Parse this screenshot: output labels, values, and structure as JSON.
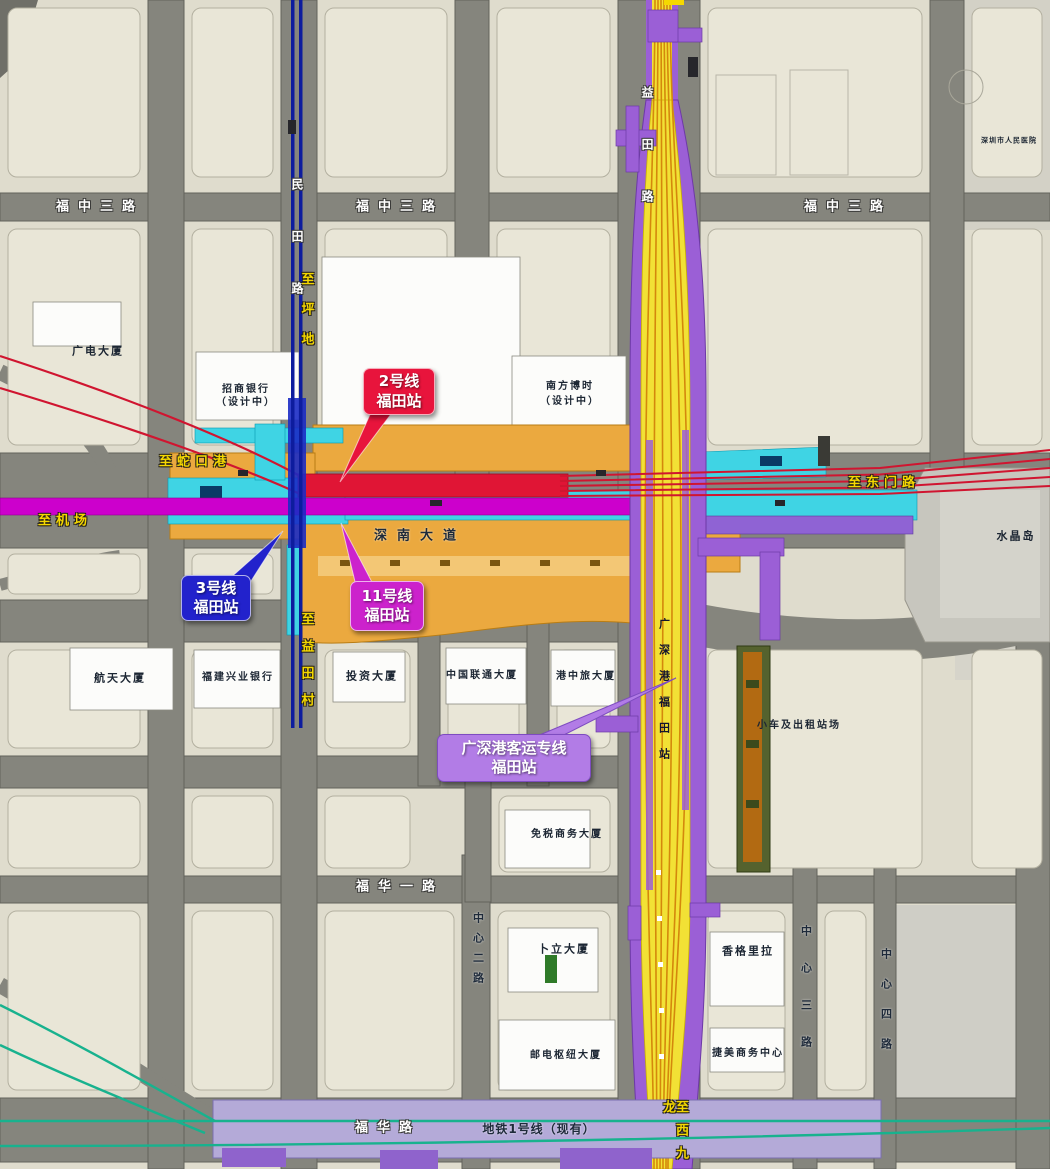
{
  "map_title": "福田站综合交通枢纽平面示意",
  "colors": {
    "line2_red": "#e8143c",
    "line3_blue": "#2222cc",
    "line11_magenta": "#cc22cc",
    "hsr_callout_purple": "#b27ce6",
    "hsr_corridor_yellow": "#f2e135",
    "corridor_flank_purple": "#9b5fd6",
    "metro1_existing_band": "#b4aad8",
    "line3_station_cyan": "#3fd4e4",
    "station_complex_orange": "#eba93f",
    "direction_label_yellow": "#f5d800",
    "teal_line_green": "#18b28e",
    "road_grey": "#85857d",
    "block_beige": "#e9e6d7"
  },
  "callouts": [
    {
      "id": "line2",
      "lines": [
        "2号线",
        "福田站"
      ],
      "color": "#e8143c"
    },
    {
      "id": "line3",
      "lines": [
        "3号线",
        "福田站"
      ],
      "color": "#2222cc"
    },
    {
      "id": "line11",
      "lines": [
        "11号线",
        "福田站"
      ],
      "color": "#cc22cc"
    },
    {
      "id": "grs",
      "lines": [
        "广深港客运专线",
        "福田站"
      ],
      "color": "#b27ce6"
    }
  ],
  "labels": [
    {
      "text": "福中三路",
      "type": "road",
      "x": 100,
      "y": 207,
      "ls": 9,
      "name": "road-label-fuzhong3-west"
    },
    {
      "text": "福中三路",
      "type": "road",
      "x": 400,
      "y": 207,
      "ls": 9,
      "name": "road-label-fuzhong3-mid"
    },
    {
      "text": "福中三路",
      "type": "road",
      "x": 848,
      "y": 207,
      "ls": 9,
      "name": "road-label-fuzhong3-east"
    },
    {
      "text": "福华一路",
      "type": "road",
      "x": 400,
      "y": 887,
      "ls": 9,
      "name": "road-label-fuhua1"
    },
    {
      "text": "福华路",
      "type": "road",
      "x": 388,
      "y": 1128,
      "ls": 9,
      "name": "road-label-fuhua"
    },
    {
      "text": "民田路",
      "type": "road",
      "x": 297,
      "y": 178,
      "ls": 40,
      "v": true,
      "fs": 12,
      "name": "road-label-mintian"
    },
    {
      "text": "益田路",
      "type": "road",
      "x": 647,
      "y": 86,
      "ls": 40,
      "v": true,
      "fs": 12,
      "name": "road-label-yitian"
    },
    {
      "text": "深南大道",
      "type": "roadDark",
      "x": 420,
      "y": 536,
      "ls": 10,
      "name": "road-label-shennan-avenue"
    },
    {
      "text": "地铁1号线（现有）",
      "type": "roadDark",
      "x": 539,
      "y": 1129,
      "ls": 1,
      "fs": 12,
      "name": "metro-line1-existing-label"
    },
    {
      "text": "中心二路",
      "type": "roadDark",
      "x": 478,
      "y": 912,
      "ls": 9,
      "fs": 11,
      "v": true,
      "name": "road-label-zhongxin2"
    },
    {
      "text": "中心三路",
      "type": "roadDark",
      "x": 806,
      "y": 925,
      "ls": 26,
      "fs": 11,
      "v": true,
      "name": "road-label-zhongxin3"
    },
    {
      "text": "中心四路",
      "type": "roadDark",
      "x": 886,
      "y": 948,
      "ls": 19,
      "fs": 11,
      "v": true,
      "name": "road-label-zhongxin4"
    },
    {
      "text": "广深港福田站",
      "type": "sta",
      "x": 664,
      "y": 618,
      "ls": 15,
      "fs": 11,
      "v": true,
      "name": "hsr-station-vertical-label"
    },
    {
      "text": "至蛇口港",
      "type": "dir",
      "x": 195,
      "y": 462,
      "ls": 5,
      "name": "direction-label-shekou-port"
    },
    {
      "text": "至机场",
      "type": "dir",
      "x": 65,
      "y": 521,
      "ls": 5,
      "name": "direction-label-airport"
    },
    {
      "text": "至东门路",
      "type": "dir",
      "x": 884,
      "y": 483,
      "ls": 5,
      "name": "direction-label-dongmen"
    },
    {
      "text": "至坪地",
      "type": "dir",
      "x": 306,
      "y": 272,
      "ls": 17,
      "v": true,
      "name": "direction-label-pingdi"
    },
    {
      "text": "至益田村",
      "type": "dir",
      "x": 306,
      "y": 612,
      "ls": 14,
      "v": true,
      "name": "direction-label-yitiancun"
    },
    {
      "text": "至西九龙",
      "type": "dir",
      "x": 674,
      "y": 1100,
      "ls": 10,
      "v": true,
      "name": "direction-label-west-kowloon"
    },
    {
      "text": "广电大厦",
      "type": "bldg",
      "x": 98,
      "y": 351,
      "name": "building-label-guangdian"
    },
    {
      "text": "招商银行",
      "type": "bldg",
      "x": 246,
      "y": 390,
      "fs": 10,
      "name": "building-label-zhaoshang-bank"
    },
    {
      "text": "（设计中）",
      "type": "bldg",
      "x": 246,
      "y": 403,
      "fs": 10,
      "name": "building-label-zhaoshang-note"
    },
    {
      "text": "南方博时",
      "type": "bldg",
      "x": 570,
      "y": 387,
      "fs": 10,
      "name": "building-label-nanfang-boshi"
    },
    {
      "text": "（设计中）",
      "type": "bldg",
      "x": 570,
      "y": 402,
      "fs": 10,
      "name": "building-label-nanfang-note"
    },
    {
      "text": "水晶岛",
      "type": "bldg",
      "x": 1016,
      "y": 536,
      "name": "area-label-crystal-island"
    },
    {
      "text": "航天大厦",
      "type": "bldg",
      "x": 120,
      "y": 678,
      "name": "building-label-hangtian"
    },
    {
      "text": "福建兴业银行",
      "type": "bldg",
      "x": 238,
      "y": 678,
      "fs": 10,
      "name": "building-label-fujian-xingye-bank"
    },
    {
      "text": "投资大厦",
      "type": "bldg",
      "x": 372,
      "y": 676,
      "name": "building-label-touzi"
    },
    {
      "text": "中国联通大厦",
      "type": "bldg",
      "x": 482,
      "y": 676,
      "fs": 10,
      "name": "building-label-china-unicom"
    },
    {
      "text": "港中旅大厦",
      "type": "bldg",
      "x": 586,
      "y": 677,
      "fs": 10,
      "name": "building-label-gangzhonglv"
    },
    {
      "text": "小车及出租站场",
      "type": "bldg",
      "x": 799,
      "y": 726,
      "fs": 10,
      "name": "area-label-car-taxi-yard"
    },
    {
      "text": "免税商务大厦",
      "type": "bldg",
      "x": 567,
      "y": 835,
      "fs": 10,
      "name": "building-label-mianshui"
    },
    {
      "text": "卜立大厦",
      "type": "bldg",
      "x": 564,
      "y": 949,
      "name": "building-label-buli"
    },
    {
      "text": "香格里拉",
      "type": "bldg",
      "x": 748,
      "y": 951,
      "name": "building-label-shangrila"
    },
    {
      "text": "邮电枢纽大厦",
      "type": "bldg",
      "x": 566,
      "y": 1056,
      "fs": 10,
      "name": "building-label-youdian-hub"
    },
    {
      "text": "捷美商务中心",
      "type": "bldg",
      "x": 748,
      "y": 1054,
      "fs": 10,
      "name": "building-label-jiemei-center"
    },
    {
      "text": "深圳市人民医院",
      "type": "bldg",
      "x": 1009,
      "y": 141,
      "fs": 7,
      "ls": 1,
      "name": "building-label-renmin"
    }
  ]
}
